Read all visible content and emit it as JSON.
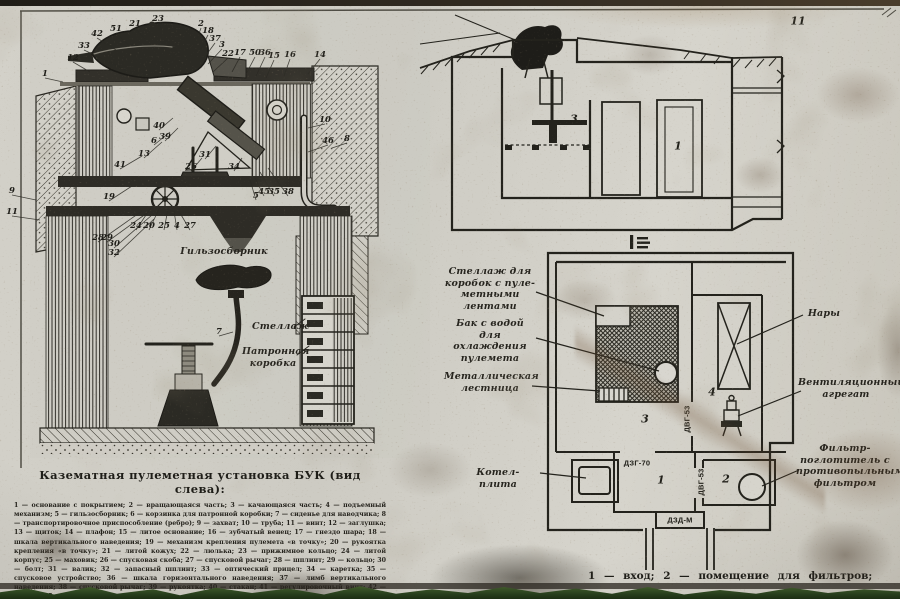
{
  "colors": {
    "ink": "#23221c",
    "poster": "#cfccc4",
    "grass": "#3e5a2c",
    "rust": "#7a5a36"
  },
  "poster": {
    "legend": {
      "title": "Казематная пулеметная установка БУК (вид слева):",
      "body": "1 — основание с покрытием; 2 — вращающаяся часть; 3 — качающаяся часть; 4 — подъемный механизм; 5 — гильзосборник; 6 — корзинка для патронной коробки; 7 — сиденье для наводчика; 8 — транспортировочное приспособление (ребро); 9 — захват; 10 — труба; 11 — винт; 12 — заглушка; 13 — щиток; 14 — плафон; 15 — литое основание; 16 — зубчатый венец; 17 — гнездо шара; 18 — шкала вертикального наведения; 19 — механизм крепления пулемета «в точку»; 20 — рукоятка крепления «в точку»; 21 — литой кожух; 22 — люлька; 23 — прижимное кольцо; 24 — литой корпус; 25 — маховик; 26 — спусковая скоба; 27 — спусковой рычаг; 28 — шплинт; 29 — кольцо; 30 — болт; 31 — валик; 32 — запасный шплинт; 33 — оптический прицел; 34 — каретка; 35 — спусковое устройство; 36 — шкала горизонтального наведения; 37 — лимб вертикального наведения; 38 — спусковой рычаг; 39 — рукоятка; 40 — стакан; 41 — регулировочный винт; 42 — втулка; 45 — трос; 46 — крючок;",
      "last_line": "50 — винт; 51 — болт крепления прижимного кольца"
    },
    "plan_caption": "1 — вход;  2 — помещение  для  фильтров;",
    "callouts": [
      {
        "n": "1",
        "x": 45,
        "y": 74,
        "tx": 63,
        "ty": 82
      },
      {
        "n": "12",
        "x": 73,
        "y": 58,
        "tx": 90,
        "ty": 72
      },
      {
        "n": "33",
        "x": 84,
        "y": 46,
        "tx": 126,
        "ty": 70
      },
      {
        "n": "42",
        "x": 97,
        "y": 34,
        "tx": 116,
        "ty": 50
      },
      {
        "n": "51",
        "x": 116,
        "y": 29,
        "tx": 130,
        "ty": 46
      },
      {
        "n": "21",
        "x": 135,
        "y": 24,
        "tx": 146,
        "ty": 40
      },
      {
        "n": "23",
        "x": 158,
        "y": 19,
        "tx": 162,
        "ty": 30
      },
      {
        "n": "2",
        "x": 201,
        "y": 24,
        "tx": 196,
        "ty": 42
      },
      {
        "n": "18",
        "x": 208,
        "y": 31,
        "tx": 200,
        "ty": 50
      },
      {
        "n": "37",
        "x": 215,
        "y": 39,
        "tx": 204,
        "ty": 58
      },
      {
        "n": "3",
        "x": 222,
        "y": 45,
        "tx": 208,
        "ty": 64
      },
      {
        "n": "22",
        "x": 228,
        "y": 54,
        "tx": 213,
        "ty": 72
      },
      {
        "n": "17",
        "x": 240,
        "y": 53,
        "tx": 232,
        "ty": 72
      },
      {
        "n": "50",
        "x": 255,
        "y": 53,
        "tx": 246,
        "ty": 74
      },
      {
        "n": "36",
        "x": 265,
        "y": 53,
        "tx": 256,
        "ty": 76
      },
      {
        "n": "15",
        "x": 274,
        "y": 56,
        "tx": 266,
        "ty": 78
      },
      {
        "n": "16",
        "x": 290,
        "y": 55,
        "tx": 284,
        "ty": 76
      },
      {
        "n": "14",
        "x": 320,
        "y": 55,
        "tx": 308,
        "ty": 74
      },
      {
        "n": "9",
        "x": 12,
        "y": 191,
        "tx": 36,
        "ty": 200
      },
      {
        "n": "11",
        "x": 12,
        "y": 212,
        "tx": 40,
        "ty": 220
      },
      {
        "n": "10",
        "x": 325,
        "y": 120,
        "tx": 308,
        "ty": 128
      },
      {
        "n": "46",
        "x": 328,
        "y": 141,
        "tx": 308,
        "ty": 152
      },
      {
        "n": "8",
        "x": 347,
        "y": 139,
        "tx": 332,
        "ty": 148
      },
      {
        "n": "40",
        "x": 159,
        "y": 126,
        "tx": 173,
        "ty": 118
      },
      {
        "n": "6",
        "x": 154,
        "y": 141,
        "tx": 170,
        "ty": 132
      },
      {
        "n": "39",
        "x": 165,
        "y": 137,
        "tx": 178,
        "ty": 128
      },
      {
        "n": "13",
        "x": 144,
        "y": 154,
        "tx": 162,
        "ty": 142
      },
      {
        "n": "41",
        "x": 120,
        "y": 165,
        "tx": 142,
        "ty": 156
      },
      {
        "n": "31",
        "x": 205,
        "y": 155,
        "tx": 216,
        "ty": 146
      },
      {
        "n": "26",
        "x": 191,
        "y": 167,
        "tx": 202,
        "ty": 158
      },
      {
        "n": "34",
        "x": 234,
        "y": 167,
        "tx": 242,
        "ty": 158
      },
      {
        "n": "19",
        "x": 109,
        "y": 197,
        "tx": 132,
        "ty": 186
      },
      {
        "n": "5",
        "x": 256,
        "y": 196,
        "tx": 250,
        "ty": 180
      },
      {
        "n": "45",
        "x": 264,
        "y": 192,
        "tx": 254,
        "ty": 176
      },
      {
        "n": "35",
        "x": 274,
        "y": 192,
        "tx": 260,
        "ty": 172
      },
      {
        "n": "38",
        "x": 288,
        "y": 192,
        "tx": 268,
        "ty": 168
      },
      {
        "n": "24",
        "x": 136,
        "y": 226,
        "tx": 152,
        "ty": 206
      },
      {
        "n": "20",
        "x": 149,
        "y": 226,
        "tx": 160,
        "ty": 207
      },
      {
        "n": "25",
        "x": 164,
        "y": 226,
        "tx": 168,
        "ty": 209
      },
      {
        "n": "4",
        "x": 177,
        "y": 226,
        "tx": 174,
        "ty": 211
      },
      {
        "n": "27",
        "x": 190,
        "y": 226,
        "tx": 180,
        "ty": 213
      },
      {
        "n": "28",
        "x": 98,
        "y": 238,
        "tx": 142,
        "ty": 211
      },
      {
        "n": "29",
        "x": 107,
        "y": 238,
        "tx": 147,
        "ty": 213
      },
      {
        "n": "30",
        "x": 114,
        "y": 244,
        "tx": 152,
        "ty": 215
      },
      {
        "n": "32",
        "x": 114,
        "y": 253,
        "tx": 154,
        "ty": 219
      },
      {
        "n": "7",
        "x": 219,
        "y": 332,
        "tx": 233,
        "ty": 332
      }
    ],
    "hand_labels": [
      {
        "text": "Гильзосборник",
        "x": 174,
        "y": 246,
        "w": 100
      },
      {
        "text": "Стеллаж",
        "x": 252,
        "y": 321,
        "w": 50
      },
      {
        "text": "Патронная\nкоробка",
        "x": 242,
        "y": 346,
        "w": 62
      },
      {
        "text": "Стеллаж для\nкоробок с пуле-\nметными лентами",
        "x": 444,
        "y": 266,
        "w": 92
      },
      {
        "text": "Бак с водой\nдля охлаждения\nпулемета",
        "x": 444,
        "y": 318,
        "w": 92
      },
      {
        "text": "Металлическая\nлестница",
        "x": 444,
        "y": 371,
        "w": 92
      },
      {
        "text": "Котел-плита",
        "x": 458,
        "y": 467,
        "w": 80
      },
      {
        "text": "Нары",
        "x": 804,
        "y": 308,
        "w": 40
      },
      {
        "text": "Вентиляционный\nагрегат",
        "x": 798,
        "y": 377,
        "w": 96
      },
      {
        "text": "Фильтр-\nпоглотитель с\nпротивопыльным\nфильтром",
        "x": 796,
        "y": 443,
        "w": 98
      }
    ],
    "room_numbers": [
      {
        "t": "3",
        "x": 645,
        "y": 419
      },
      {
        "t": "4",
        "x": 712,
        "y": 392
      },
      {
        "t": "1",
        "x": 661,
        "y": 480
      },
      {
        "t": "2",
        "x": 726,
        "y": 479
      },
      {
        "t": "3",
        "x": 574,
        "y": 119
      },
      {
        "t": "1",
        "x": 678,
        "y": 146
      },
      {
        "t": "11",
        "x": 798,
        "y": 21
      }
    ],
    "door_labels": [
      {
        "t": "ДВГ-53",
        "x": 687,
        "y": 419,
        "rot": true
      },
      {
        "t": "ДЗГ-70",
        "x": 637,
        "y": 463,
        "rot": false
      },
      {
        "t": "ДВГ-53",
        "x": 701,
        "y": 482,
        "rot": true
      },
      {
        "t": "ДЗД-М",
        "x": 680,
        "y": 520,
        "rot": false
      }
    ]
  }
}
